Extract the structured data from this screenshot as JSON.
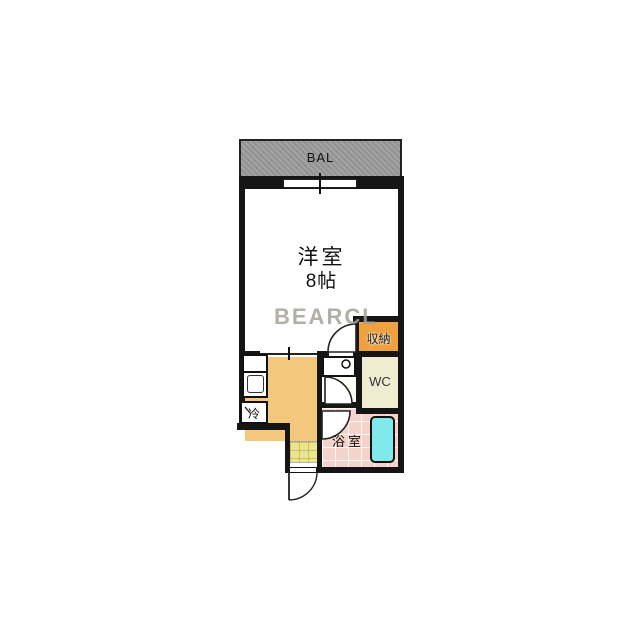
{
  "watermark": "BEARCL",
  "balcony": {
    "label": "BAL"
  },
  "main_room": {
    "name": "洋室",
    "size": "8帖"
  },
  "closet": {
    "label": "収納"
  },
  "toilet": {
    "label": "WC"
  },
  "bathroom": {
    "label": "浴室"
  },
  "kitchen": {
    "fridge_label": "冷"
  },
  "colors": {
    "wall": "#151515",
    "balcony": "#9b9b9b",
    "main_room": "#f3eacc",
    "kitchen": "#f3c77c",
    "closet": "#efa13f",
    "genkan": "#ebe68d",
    "bathroom": "#f5d2ca",
    "bathtub": "#7fe9eb",
    "wc": "#f0ecd2",
    "watermark": "#a5a099"
  }
}
